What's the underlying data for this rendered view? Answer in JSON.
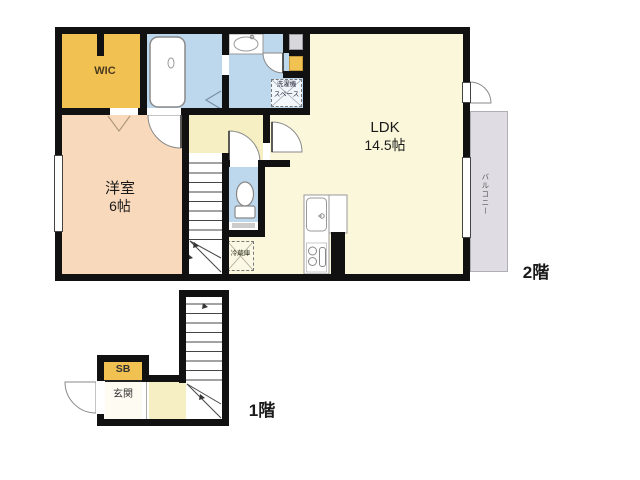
{
  "floor2": {
    "floor_label": "2階",
    "wic": "WIC",
    "bedroom_name": "洋室",
    "bedroom_size": "6帖",
    "ldk_name": "LDK",
    "ldk_size": "14.5帖",
    "balcony": "バルコニー",
    "laundry_line1": "洗濯機",
    "laundry_line2": "スペース",
    "fridge": "冷蔵庫"
  },
  "floor1": {
    "floor_label": "1階",
    "shoebox": "SB",
    "entrance": "玄関"
  },
  "colors": {
    "wall": "#111111",
    "wic_orange": "#F1C252",
    "bedroom_peach": "#F9D9BC",
    "ldk_cream": "#FAF7DA",
    "hall_cream": "#F5EFC3",
    "wet_area_blue": "#BDD7EC",
    "balcony_gray": "#DFDDE3",
    "storage_gray": "#D8D8DC"
  }
}
